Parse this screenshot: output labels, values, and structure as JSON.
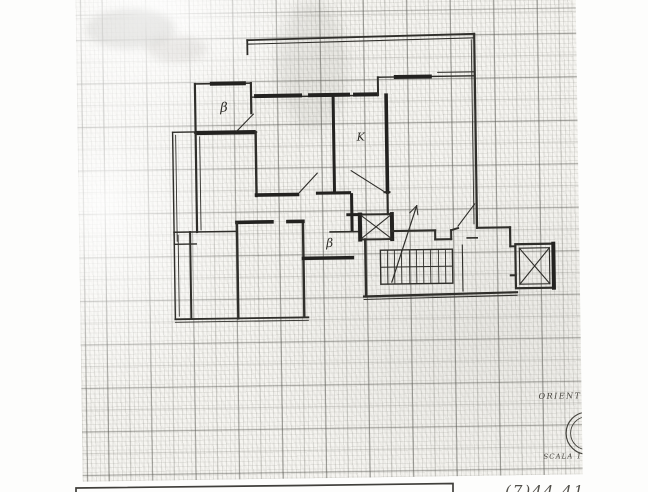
{
  "document": {
    "type": "scanned floor plan on millimeter graph paper",
    "paper_color": "#f6f5f1",
    "grid_color": "#8e8d86",
    "ink_color": "#2f2e2a"
  },
  "plan": {
    "room_labels": [
      {
        "text": "β"
      },
      {
        "text": "K"
      },
      {
        "text": "β"
      }
    ],
    "features": [
      "terrace",
      "balconies",
      "staircase",
      "stair-direction-arrow",
      "ventilation-shaft",
      "elevator-shaft",
      "door-swings"
    ]
  },
  "annotations": {
    "orientation_label": "ORIENT",
    "scale_label": "SCALA 1:",
    "handwritten_note": "(7)44 41"
  }
}
